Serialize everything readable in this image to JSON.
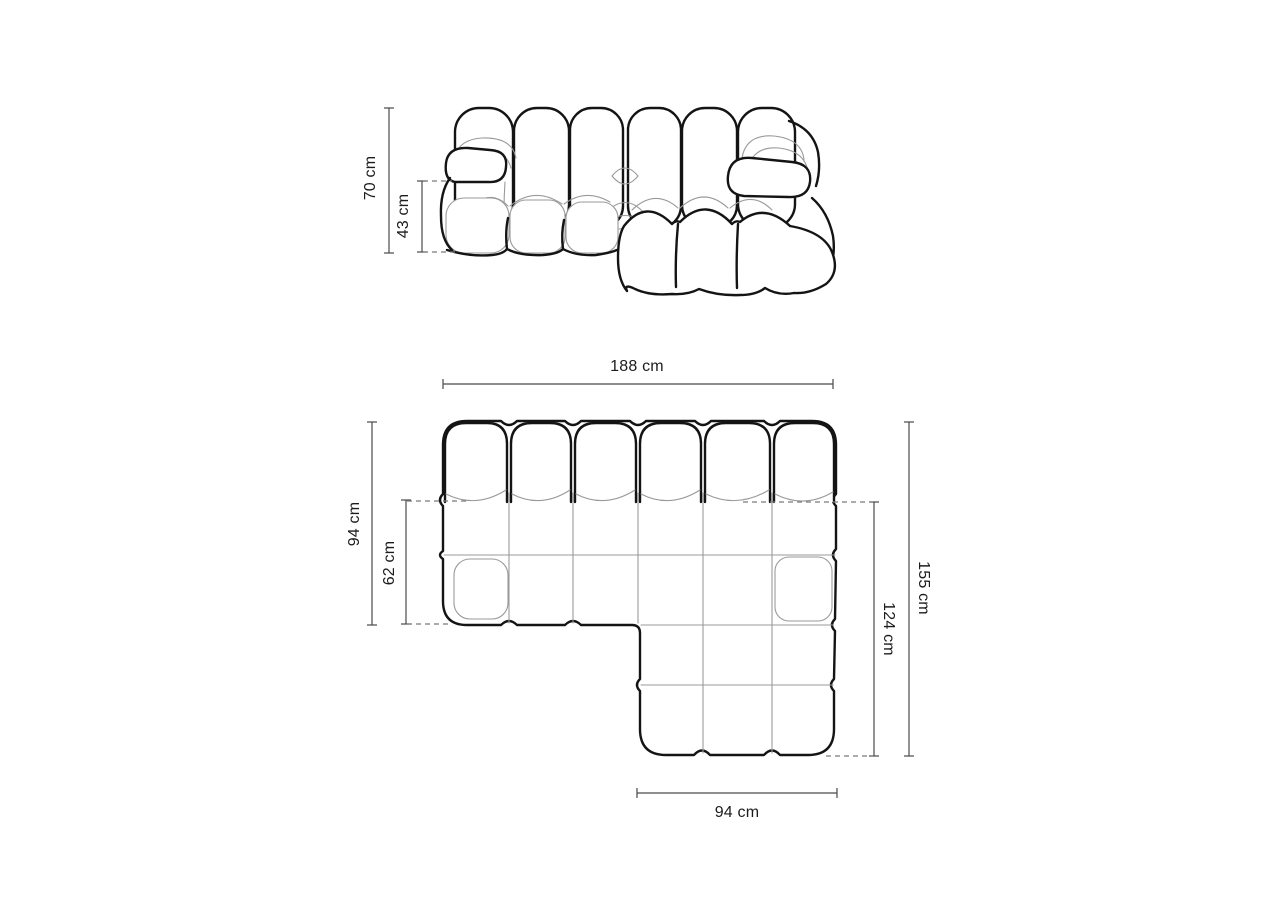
{
  "diagram": {
    "type": "sofa-dimension-drawing",
    "unit": "cm",
    "views": {
      "front": {
        "labels": {
          "overall_height": "70 cm",
          "seat_height": "43 cm"
        }
      },
      "top": {
        "labels": {
          "overall_width": "188 cm",
          "side_depth": "94 cm",
          "seat_depth": "62 cm",
          "overall_depth": "155 cm",
          "chaise_inner_length": "124 cm",
          "chaise_width": "94 cm"
        }
      }
    },
    "colors": {
      "background": "#ffffff",
      "outline": "#141414",
      "inner_line": "#9a9a9a",
      "dimension_line": "#4a4a4a",
      "dashed_line": "#7a7a7a",
      "text": "#1c1c1c"
    }
  }
}
